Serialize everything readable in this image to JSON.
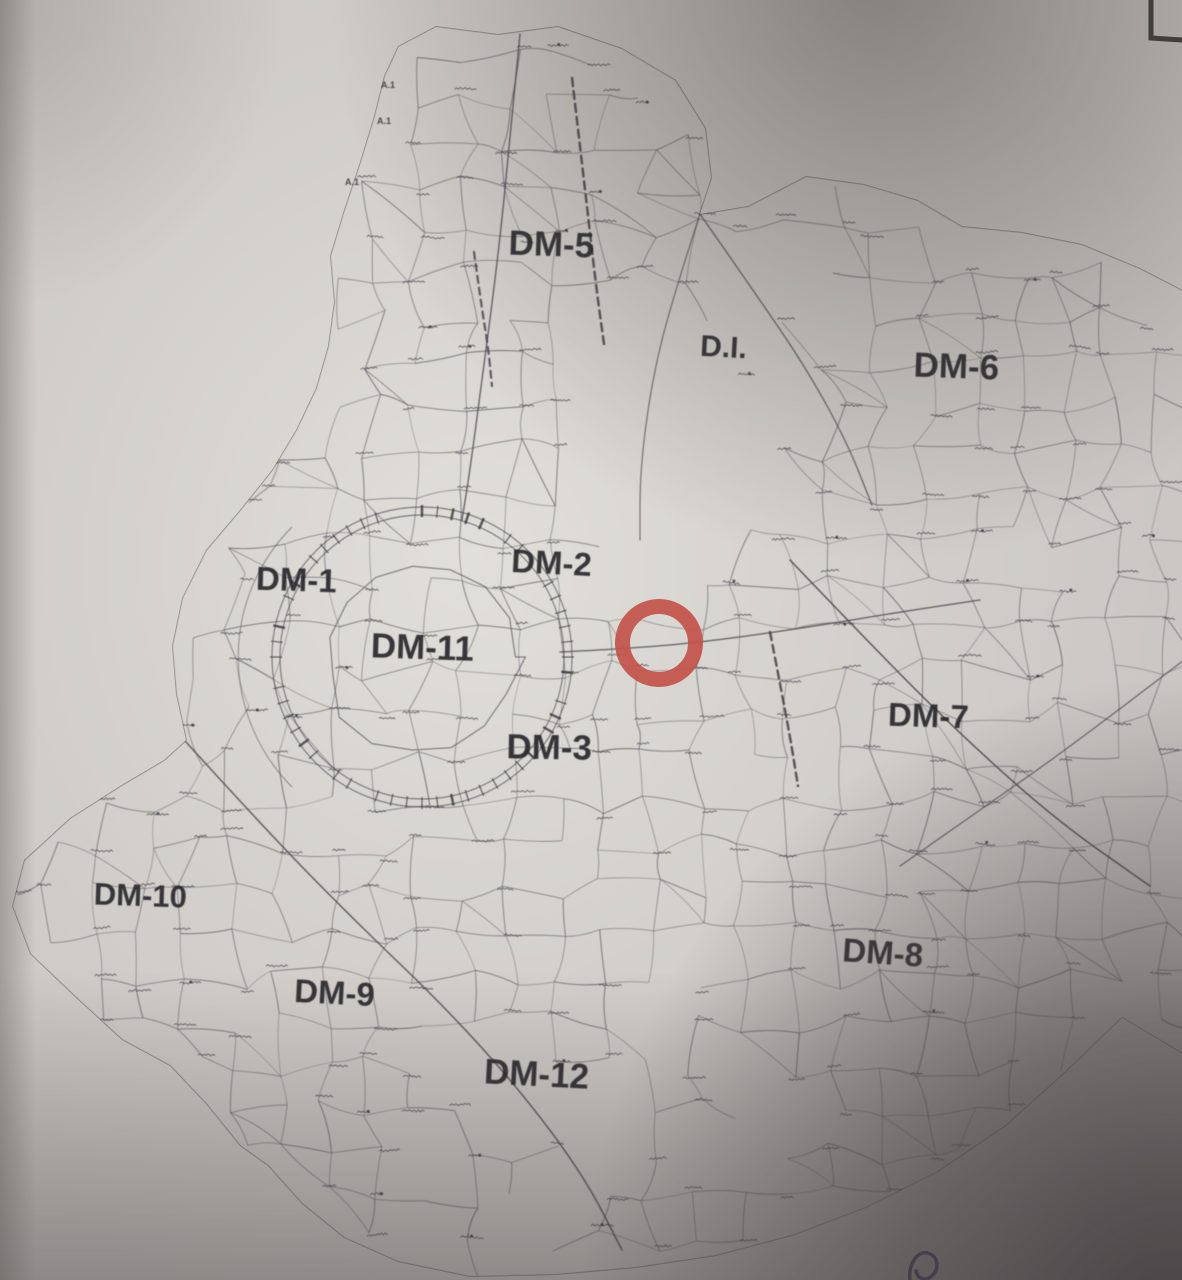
{
  "map": {
    "zone_labels": [
      {
        "id": "dm-5",
        "text": "DM-5",
        "x": 551,
        "y": 256,
        "size": 35,
        "rotate": 2
      },
      {
        "id": "d-i",
        "text": "D.I.",
        "x": 723,
        "y": 357,
        "size": 30,
        "rotate": 3
      },
      {
        "id": "dm-6",
        "text": "DM-6",
        "x": 956,
        "y": 378,
        "size": 35,
        "rotate": 2
      },
      {
        "id": "dm-1",
        "text": "DM-1",
        "x": 296,
        "y": 591,
        "size": 33,
        "rotate": 2
      },
      {
        "id": "dm-2",
        "text": "DM-2",
        "x": 551,
        "y": 574,
        "size": 33,
        "rotate": 3
      },
      {
        "id": "dm-11",
        "text": "DM-11",
        "x": 422,
        "y": 659,
        "size": 35,
        "rotate": 2
      },
      {
        "id": "dm-7",
        "text": "DM-7",
        "x": 928,
        "y": 727,
        "size": 33,
        "rotate": 2
      },
      {
        "id": "dm-3",
        "text": "DM-3",
        "x": 549,
        "y": 759,
        "size": 35,
        "rotate": 1
      },
      {
        "id": "dm-10",
        "text": "DM-10",
        "x": 140,
        "y": 906,
        "size": 31,
        "rotate": 2
      },
      {
        "id": "dm-8",
        "text": "DM-8",
        "x": 882,
        "y": 964,
        "size": 33,
        "rotate": 4
      },
      {
        "id": "dm-9",
        "text": "DM-9",
        "x": 334,
        "y": 1004,
        "size": 33,
        "rotate": 3
      },
      {
        "id": "dm-12",
        "text": "DM-12",
        "x": 536,
        "y": 1086,
        "size": 35,
        "rotate": 3
      }
    ],
    "small_labels": [
      {
        "text": "A.1",
        "x": 388,
        "y": 88
      },
      {
        "text": "A.1",
        "x": 384,
        "y": 124
      },
      {
        "text": "A.1",
        "x": 352,
        "y": 185
      }
    ],
    "annotation_circle": {
      "x": 659,
      "y": 643,
      "outer_radius": 44,
      "ring_width": 15,
      "color": "#c3544b"
    },
    "ring_center": {
      "x": 422,
      "y": 657
    },
    "outline": [
      [
        398,
        46
      ],
      [
        436,
        26
      ],
      [
        498,
        34
      ],
      [
        558,
        26
      ],
      [
        622,
        48
      ],
      [
        676,
        80
      ],
      [
        706,
        128
      ],
      [
        712,
        178
      ],
      [
        700,
        214
      ],
      [
        748,
        206
      ],
      [
        806,
        176
      ],
      [
        864,
        184
      ],
      [
        918,
        200
      ],
      [
        962,
        226
      ],
      [
        1022,
        232
      ],
      [
        1082,
        244
      ],
      [
        1140,
        268
      ],
      [
        1210,
        304
      ],
      [
        1210,
        1070
      ],
      [
        1122,
        1018
      ],
      [
        1066,
        1072
      ],
      [
        1006,
        1126
      ],
      [
        938,
        1172
      ],
      [
        866,
        1208
      ],
      [
        792,
        1236
      ],
      [
        716,
        1256
      ],
      [
        636,
        1268
      ],
      [
        556,
        1275
      ],
      [
        470,
        1277
      ],
      [
        398,
        1262
      ],
      [
        344,
        1238
      ],
      [
        302,
        1204
      ],
      [
        268,
        1166
      ],
      [
        240,
        1146
      ],
      [
        206,
        1104
      ],
      [
        170,
        1066
      ],
      [
        122,
        1040
      ],
      [
        74,
        996
      ],
      [
        30,
        954
      ],
      [
        12,
        906
      ],
      [
        24,
        860
      ],
      [
        70,
        818
      ],
      [
        120,
        786
      ],
      [
        164,
        760
      ],
      [
        186,
        740
      ],
      [
        176,
        694
      ],
      [
        172,
        646
      ],
      [
        182,
        598
      ],
      [
        206,
        550
      ],
      [
        240,
        510
      ],
      [
        272,
        470
      ],
      [
        296,
        430
      ],
      [
        316,
        388
      ],
      [
        328,
        346
      ],
      [
        334,
        302
      ],
      [
        330,
        256
      ],
      [
        344,
        210
      ],
      [
        360,
        162
      ],
      [
        374,
        116
      ],
      [
        384,
        76
      ]
    ]
  },
  "artifacts": {
    "corner_frame": {
      "color": "#33312e"
    },
    "pen_mark": {
      "color": "#2b2f6b"
    }
  },
  "colors": {
    "paper": "#c9c6c3",
    "paper_light": "#e4e2dd",
    "parcel_line": "#56545b",
    "road_line": "#3f3d43",
    "label_ink": "#28272c",
    "micro_ink": "#46444b",
    "shadow": "#484244",
    "annotation_red": "#c3544b",
    "pen_blue": "#2b2f6b"
  }
}
